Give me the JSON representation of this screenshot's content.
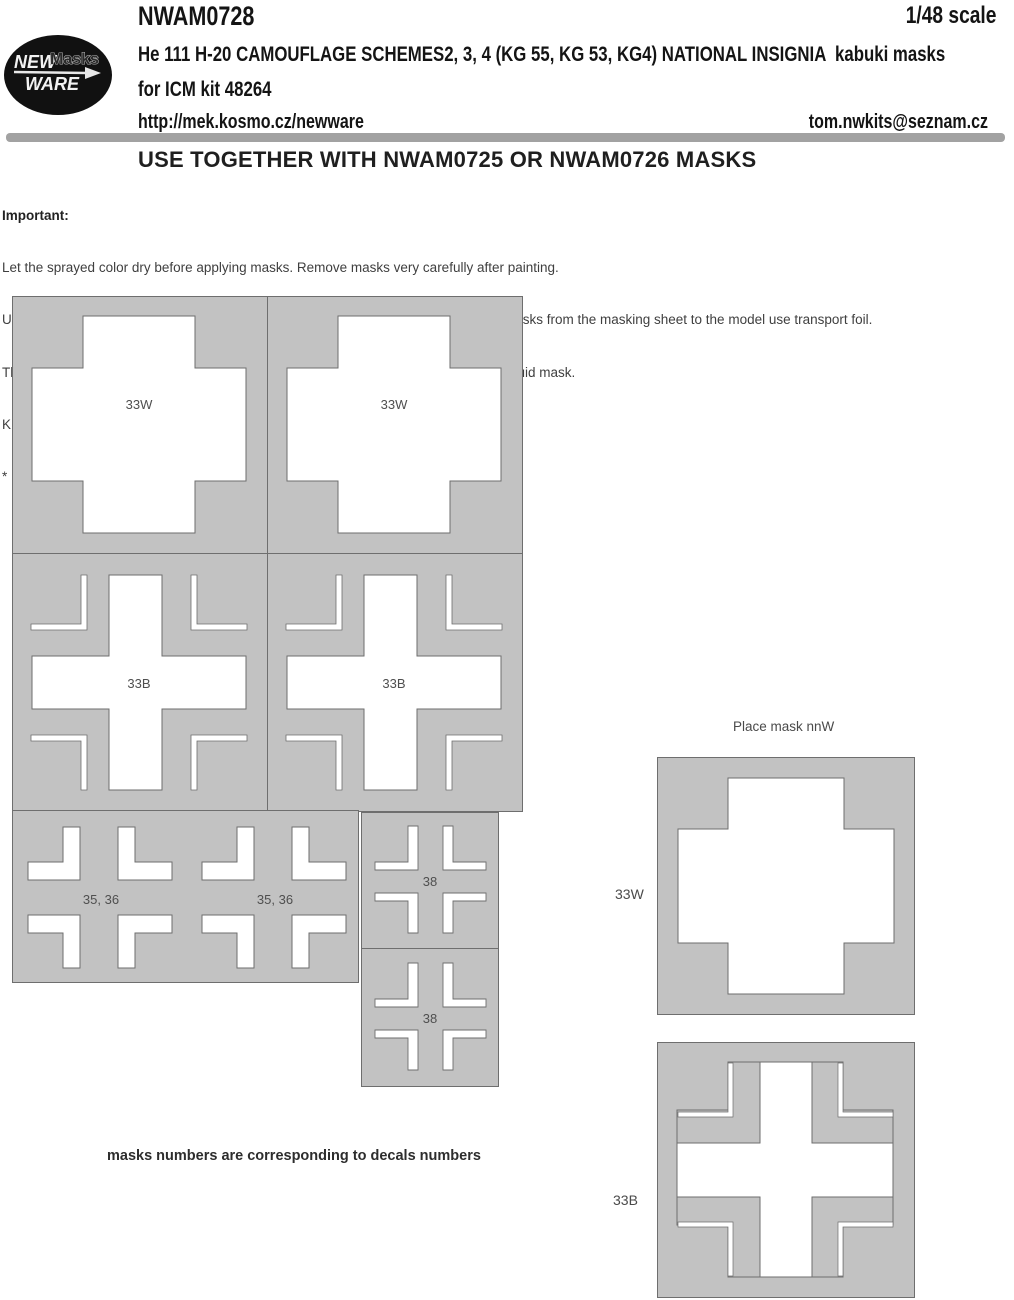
{
  "header": {
    "logo": {
      "word1": "NEW",
      "word2": "Masks",
      "word3": "WARE"
    },
    "product_code": "NWAM0728",
    "scale": "1/48 scale",
    "title_line1": "He 111 H-20 CAMOUFLAGE SCHEMES2, 3, 4 (KG 55, KG 53, KG4) NATIONAL INSIGNIA  kabuki masks",
    "title_line2": "for ICM kit 48264",
    "website": "http://mek.kosmo.cz/newware",
    "email": "tom.nwkits@seznam.cz"
  },
  "notice": "USE TOGETHER WITH NWAM0725 OR NWAM0726 MASKS",
  "instructions": {
    "heading": "Important:",
    "lines": [
      "Let the sprayed color dry before applying masks. Remove masks very carefully after painting.",
      "Use masks for replacement of decals with corresponding numbers. For transporting masks from the masking sheet to the model use transport foil.",
      "The set does not include masks for all areas, so mask the rest with masking tape or liquid mask.",
      "K kit part",
      "*  start placing the mask from this point"
    ]
  },
  "placement_note": {
    "lines": [
      "Place mask nnW",
      "paint white",
      "place mask nnB",
      "paint black"
    ]
  },
  "mask_labels": {
    "white_cross": "33W",
    "black_cross": "33B",
    "corner_set_large": "35, 36",
    "corner_set_small": "38"
  },
  "footer_note": "masks numbers are corresponding to decals numbers",
  "colors": {
    "mask_fill": "#c2c2c2",
    "mask_stroke": "#6e6e6e",
    "divider_bar": "#a2a2a2",
    "logo_background": "#111111"
  }
}
